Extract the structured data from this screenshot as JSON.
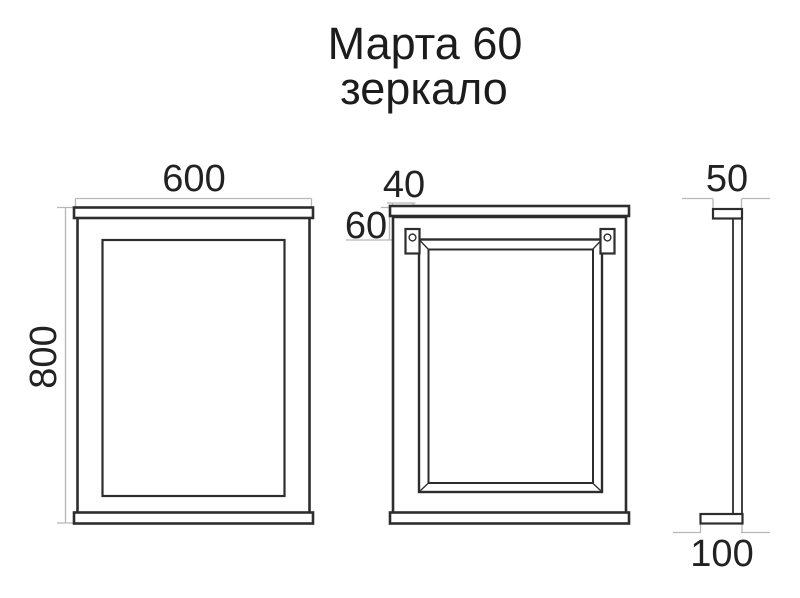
{
  "title": {
    "line1": "Марта 60",
    "line2": "зеркало"
  },
  "dimensions": {
    "front_width": "600",
    "front_height": "800",
    "hanger_offset_x": "40",
    "hanger_offset_y": "60",
    "top_depth": "50",
    "bottom_depth": "100"
  },
  "colors": {
    "background": "#ffffff",
    "drawing_line": "#2d2d2d",
    "dimension_line": "#b7b7b7",
    "text": "#1c1c1c"
  }
}
